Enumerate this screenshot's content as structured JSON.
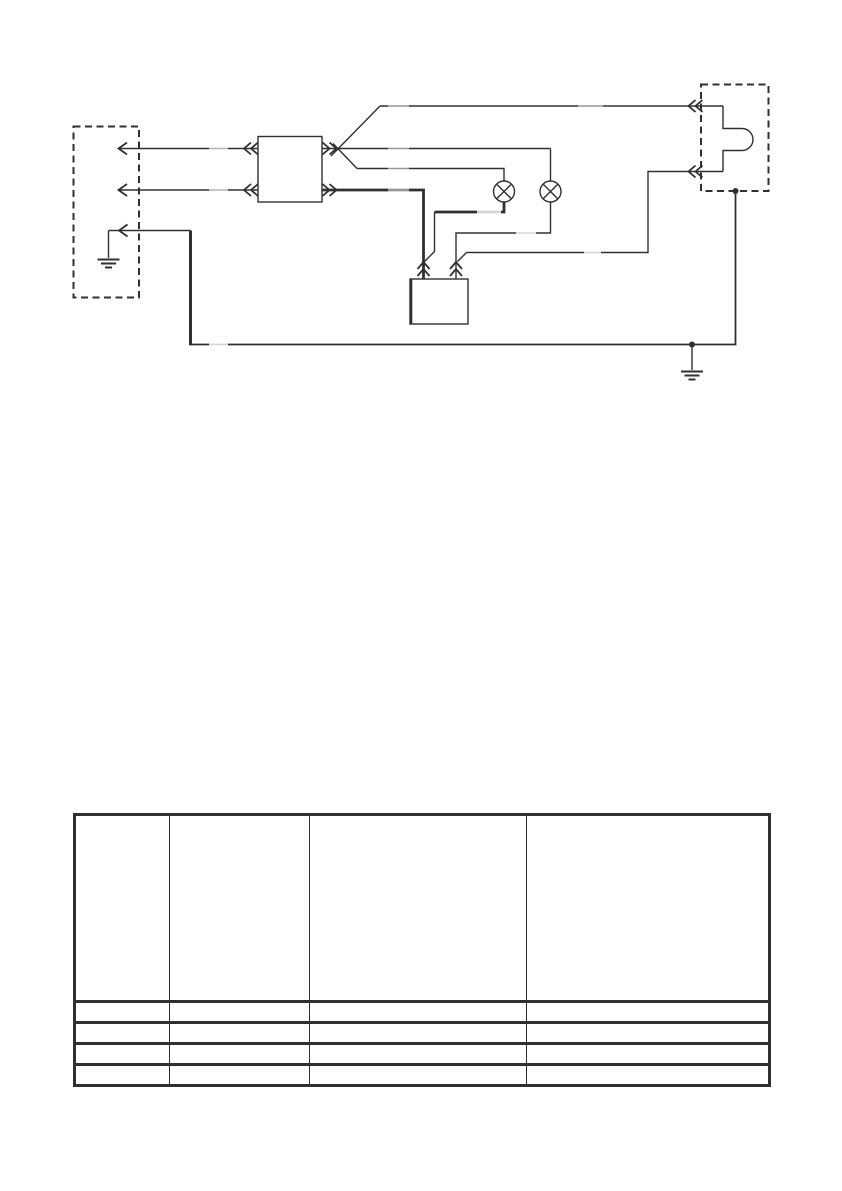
{
  "colors": {
    "ink": "#303030",
    "paper": "#ffffff"
  },
  "diagram": {
    "description_of_symbols": [
      "left-dashed-connector-box",
      "arrow-terminal",
      "relay-box",
      "lamp-symbol",
      "lamp-symbol",
      "control-unit-box",
      "right-dashed-plug-box",
      "ground-symbol",
      "ground-symbol",
      "junction-dot"
    ]
  },
  "table": {
    "column_count": 4,
    "rows": [
      {
        "cells": [
          "",
          "",
          "",
          ""
        ]
      },
      {
        "cells": [
          "",
          "",
          "",
          ""
        ]
      },
      {
        "cells": [
          "",
          "",
          "",
          ""
        ]
      },
      {
        "cells": [
          "",
          "",
          "",
          ""
        ]
      },
      {
        "cells": [
          "",
          "",
          "",
          ""
        ]
      }
    ]
  }
}
